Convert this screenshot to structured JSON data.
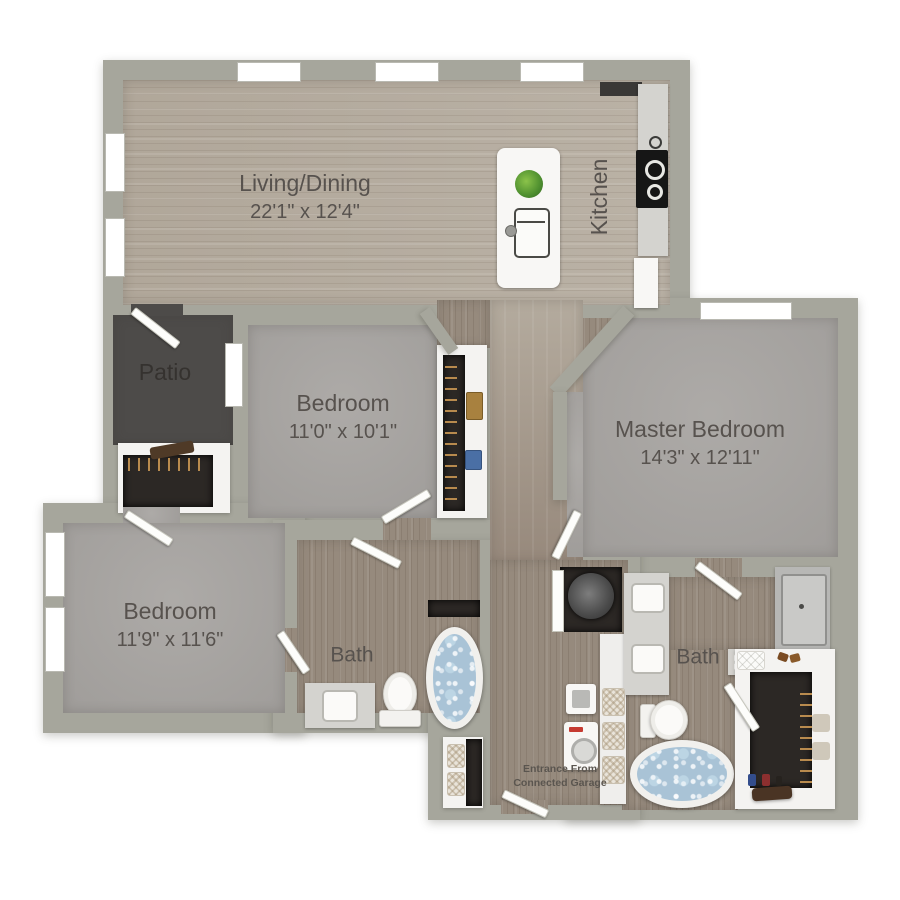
{
  "plan": {
    "title": "2 Bedroom 2 Bath Floor Plan",
    "rooms": {
      "living_dining": {
        "label": "Living/Dining",
        "dimensions": "22'1\" x 12'4\""
      },
      "kitchen": {
        "label": "Kitchen"
      },
      "patio": {
        "label": "Patio"
      },
      "bedroom_middle": {
        "label": "Bedroom",
        "dimensions": "11'0\" x 10'1\""
      },
      "master_bedroom": {
        "label": "Master Bedroom",
        "dimensions": "14'3\" x 12'11\""
      },
      "bedroom_left": {
        "label": "Bedroom",
        "dimensions": "11'9\" x 11'6\""
      },
      "bath_main": {
        "label": "Bath"
      },
      "bath_master": {
        "label": "Bath"
      }
    },
    "annotations": {
      "entrance_line1": "Entrance From",
      "entrance_line2": "Connected Garage"
    },
    "fixtures": [
      "kitchen-island",
      "island-sink",
      "plant",
      "stove-cooktop",
      "kitchen-counter",
      "refrigerator",
      "soaking-tub",
      "toilet",
      "vanity-sink",
      "double-vanity",
      "shower-stall",
      "washer",
      "dryer",
      "water-heater",
      "wicker-basket",
      "closet-rod-hangers",
      "bench",
      "shoes",
      "towel-shelf",
      "pillow"
    ],
    "palette": {
      "wall": "#a6a69c",
      "wood_light": "#b6ada0",
      "wood_dark": "#968a7d",
      "carpet": "#a8a5a2",
      "patio": "#4d4b49",
      "closet_dark": "#2c2825",
      "fixture_white": "#f8f7f5",
      "counter": "#d4d3cf",
      "water": "#a9c3d6",
      "text": "#57524e"
    }
  }
}
